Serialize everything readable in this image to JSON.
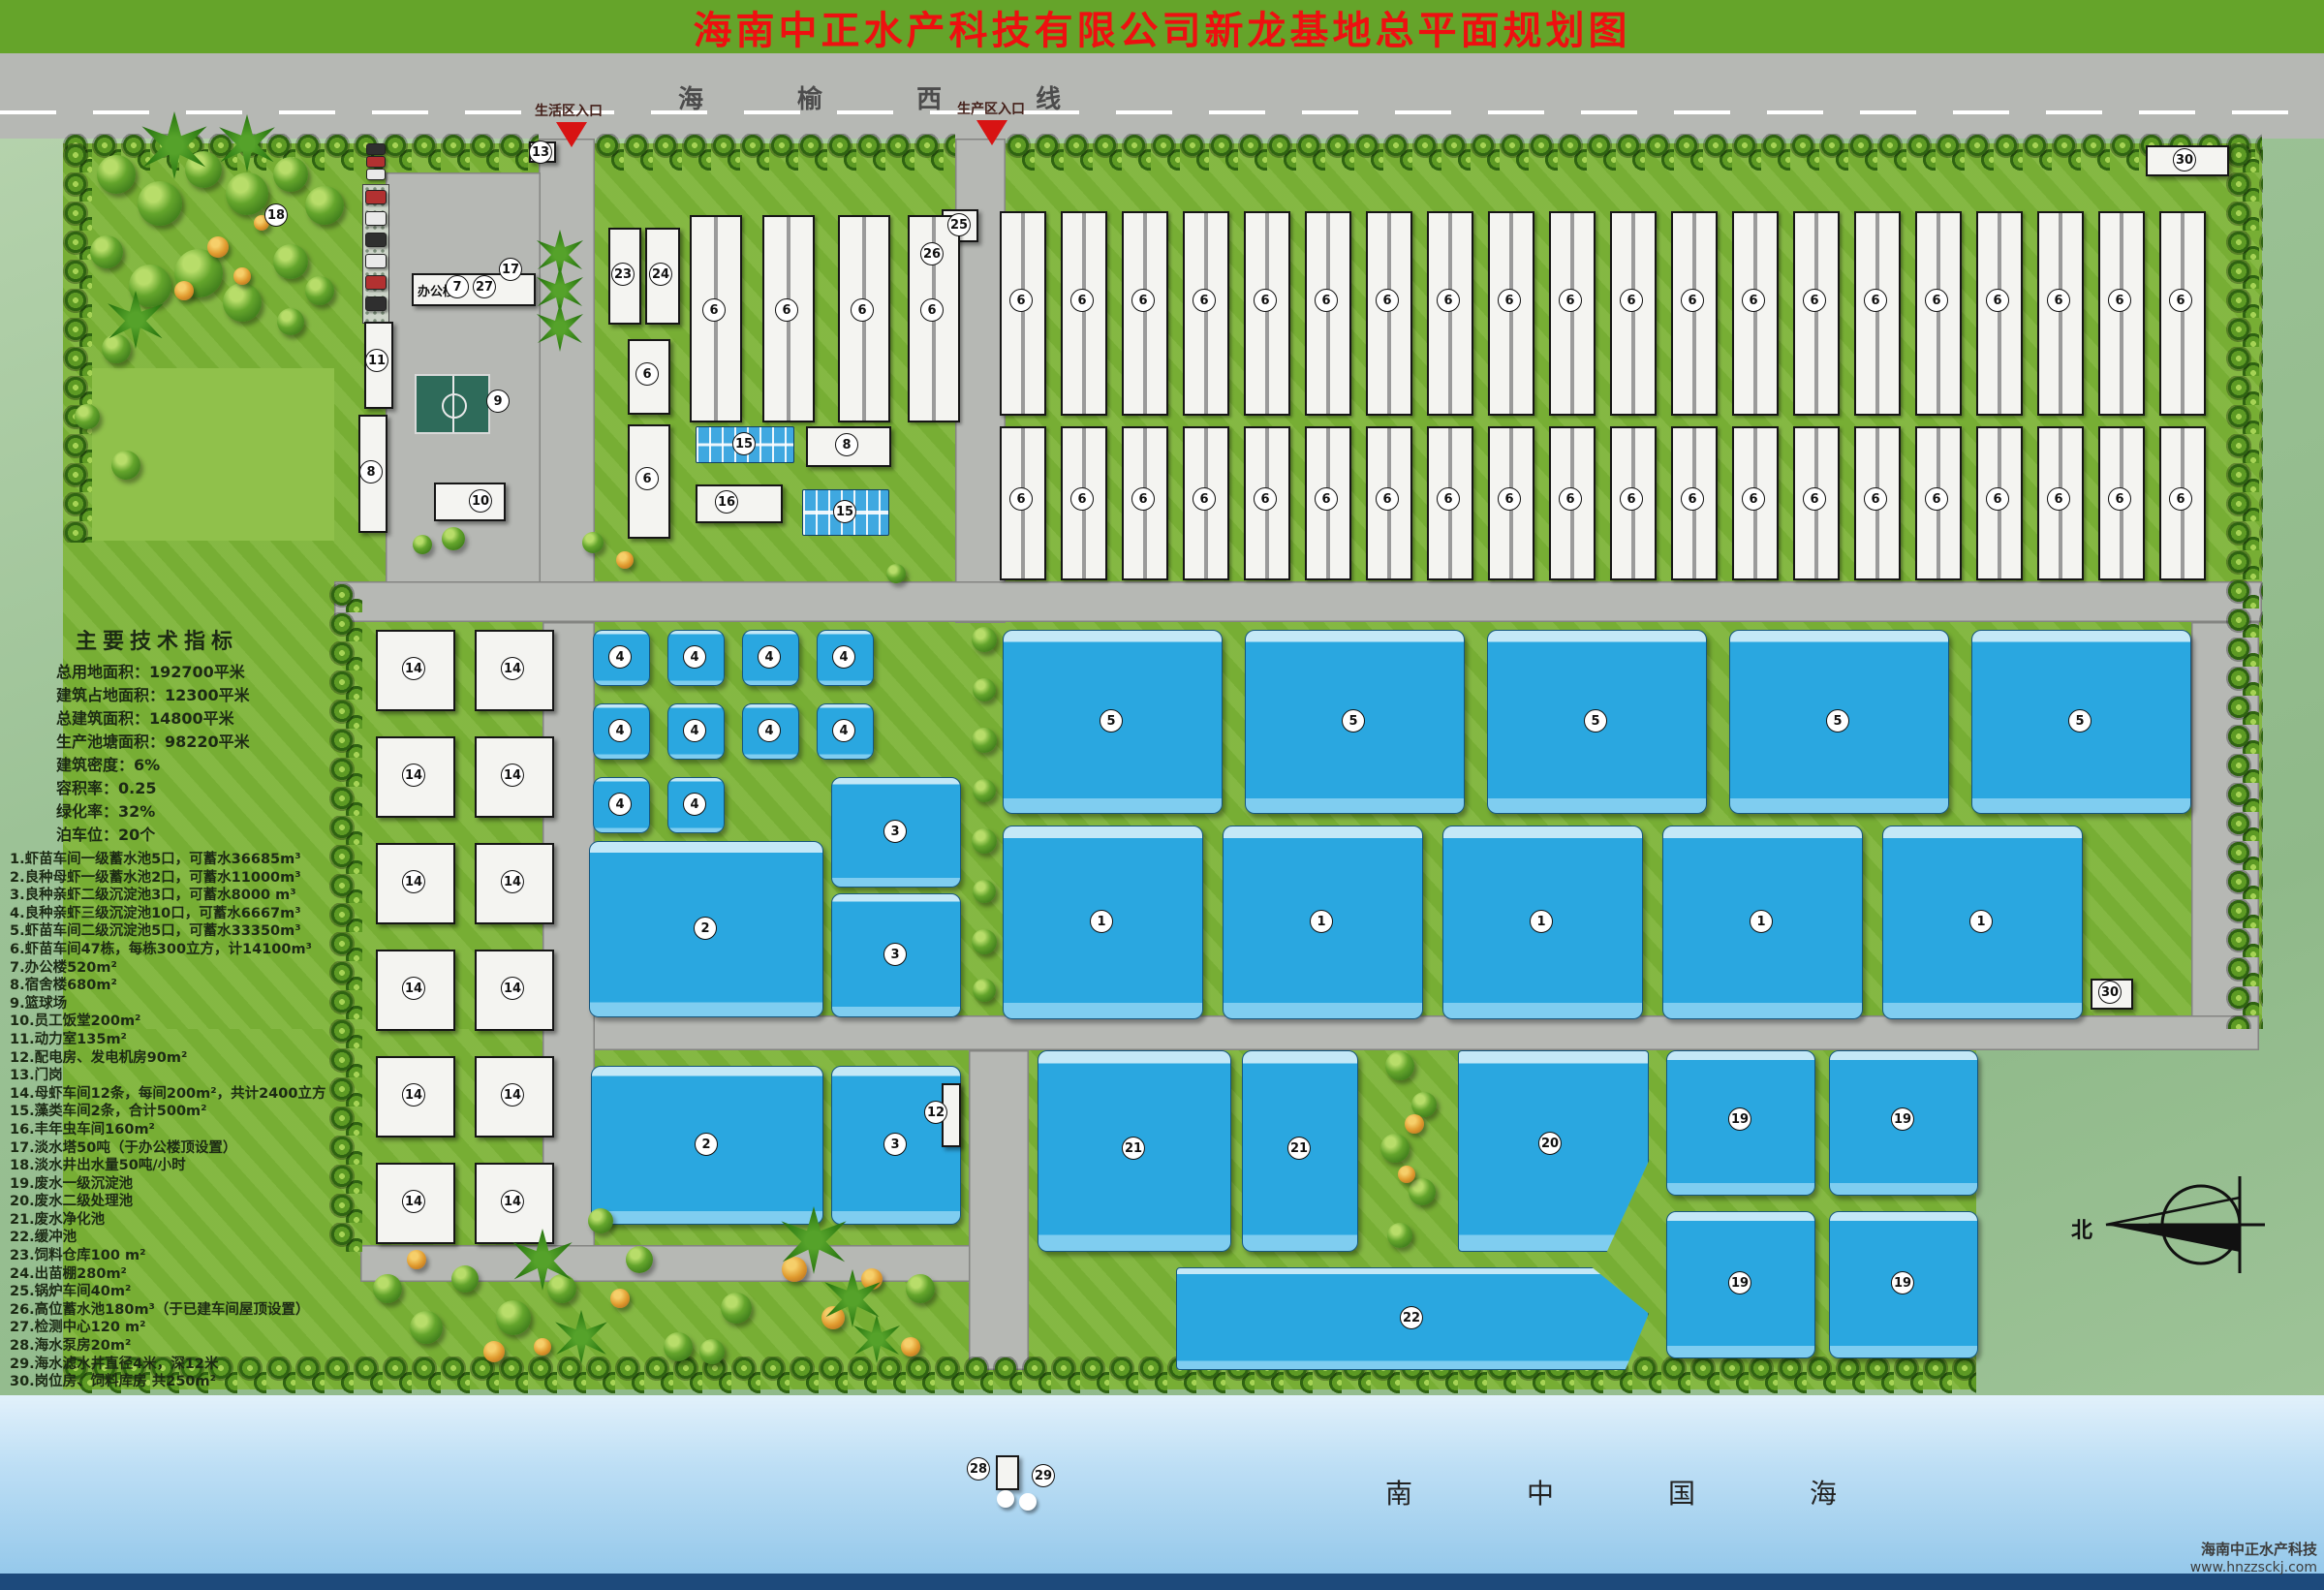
{
  "title": "海南中正水产科技有限公司新龙基地总平面规划图",
  "road": {
    "name": "海  榆  西  线",
    "entry_life": "生活区入口",
    "entry_prod": "生产区入口"
  },
  "sea": {
    "label": "南中国海"
  },
  "compass": {
    "label": "北"
  },
  "office_label": "办公楼",
  "watermark": {
    "company": "海南中正水产科技",
    "url": "www.hnzzsckj.com"
  },
  "indicators": {
    "heading": "主要技术指标",
    "lines": [
      "总用地面积：192700平米",
      "建筑占地面积：12300平米",
      "总建筑面积：14800平米",
      "生产池塘面积：98220平米",
      "建筑密度：6%",
      "容积率：0.25",
      "绿化率：32%",
      "泊车位：20个"
    ]
  },
  "legend": [
    "1.虾苗车间一级蓄水池5口，可蓄水36685m³",
    "2.良种母虾一级蓄水池2口，可蓄水11000m³",
    "3.良种亲虾二级沉淀池3口，可蓄水8000 m³",
    "4.良种亲虾三级沉淀池10口，可蓄水6667m³",
    "5.虾苗车间二级沉淀池5口，可蓄水33350m³",
    "6.虾苗车间47栋，每栋300立方，计14100m³",
    "7.办公楼520m²",
    "8.宿舍楼680m²",
    "9.篮球场",
    "10.员工饭堂200m²",
    "11.动力室135m²",
    "12.配电房、发电机房90m²",
    "13.门岗",
    "14.母虾车间12条，每间200m²，共计2400立方",
    "15.藻类车间2条，合计500m²",
    "16.丰年虫车间160m²",
    "17.淡水塔50吨（于办公楼顶设置）",
    "18.淡水井出水量50吨/小时",
    "19.废水一级沉淀池",
    "20.废水二级处理池",
    "21.废水净化池",
    "22.缓冲池",
    "23.饲料仓库100 m²",
    "24.出苗棚280m²",
    "25.锅炉车间40m²",
    "26.高位蓄水池180m³（于已建车间屋顶设置）",
    "27.检测中心120 m²",
    "28.海水泵房20m²",
    "29.海水滤水井直径4米，深12米",
    "30.岗位房、饲料库房 共250m²"
  ],
  "colors": {
    "title_bg": "#65a42a",
    "title_text": "#ee1010",
    "site_green": "#7db437",
    "road_gray": "#b6b8b4",
    "pond_blue": "#2aa7e0",
    "sea_blue": "#8fc5e9",
    "bar_navy": "#1d4a7c"
  },
  "markers": [
    [
      18,
      285,
      222
    ],
    [
      13,
      558,
      157
    ],
    [
      7,
      472,
      296
    ],
    [
      27,
      500,
      296
    ],
    [
      17,
      527,
      278
    ],
    [
      11,
      389,
      372
    ],
    [
      8,
      383,
      487
    ],
    [
      9,
      514,
      414
    ],
    [
      10,
      496,
      517
    ],
    [
      23,
      643,
      283
    ],
    [
      24,
      682,
      283
    ],
    [
      6,
      737,
      320
    ],
    [
      6,
      812,
      320
    ],
    [
      6,
      890,
      320
    ],
    [
      6,
      962,
      320
    ],
    [
      6,
      668,
      386
    ],
    [
      6,
      668,
      494
    ],
    [
      25,
      990,
      232
    ],
    [
      26,
      962,
      262
    ],
    [
      15,
      768,
      458
    ],
    [
      16,
      750,
      518
    ],
    [
      8,
      874,
      459
    ],
    [
      14,
      427,
      690
    ],
    [
      14,
      529,
      690
    ],
    [
      14,
      427,
      800
    ],
    [
      14,
      529,
      800
    ],
    [
      14,
      427,
      910
    ],
    [
      14,
      529,
      910
    ],
    [
      14,
      427,
      1020
    ],
    [
      14,
      529,
      1020
    ],
    [
      14,
      427,
      1130
    ],
    [
      14,
      529,
      1130
    ],
    [
      14,
      427,
      1240
    ],
    [
      14,
      529,
      1240
    ],
    [
      4,
      640,
      678
    ],
    [
      4,
      717,
      678
    ],
    [
      4,
      794,
      678
    ],
    [
      4,
      871,
      678
    ],
    [
      4,
      640,
      754
    ],
    [
      4,
      717,
      754
    ],
    [
      4,
      794,
      754
    ],
    [
      4,
      871,
      754
    ],
    [
      4,
      640,
      830
    ],
    [
      4,
      717,
      830
    ],
    [
      3,
      924,
      858
    ],
    [
      2,
      728,
      958
    ],
    [
      3,
      924,
      985
    ],
    [
      15,
      872,
      528
    ],
    [
      6,
      1054,
      310
    ],
    [
      6,
      1117,
      310
    ],
    [
      6,
      1180,
      310
    ],
    [
      6,
      1243,
      310
    ],
    [
      6,
      1306,
      310
    ],
    [
      6,
      1369,
      310
    ],
    [
      6,
      1432,
      310
    ],
    [
      6,
      1495,
      310
    ],
    [
      6,
      1558,
      310
    ],
    [
      6,
      1621,
      310
    ],
    [
      6,
      1684,
      310
    ],
    [
      6,
      1747,
      310
    ],
    [
      6,
      1810,
      310
    ],
    [
      6,
      1873,
      310
    ],
    [
      6,
      1936,
      310
    ],
    [
      6,
      1999,
      310
    ],
    [
      6,
      2062,
      310
    ],
    [
      6,
      2125,
      310
    ],
    [
      6,
      2188,
      310
    ],
    [
      6,
      2251,
      310
    ],
    [
      6,
      1054,
      515
    ],
    [
      6,
      1117,
      515
    ],
    [
      6,
      1180,
      515
    ],
    [
      6,
      1243,
      515
    ],
    [
      6,
      1306,
      515
    ],
    [
      6,
      1369,
      515
    ],
    [
      6,
      1432,
      515
    ],
    [
      6,
      1495,
      515
    ],
    [
      6,
      1558,
      515
    ],
    [
      6,
      1621,
      515
    ],
    [
      6,
      1684,
      515
    ],
    [
      6,
      1747,
      515
    ],
    [
      6,
      1810,
      515
    ],
    [
      6,
      1873,
      515
    ],
    [
      6,
      1936,
      515
    ],
    [
      6,
      1999,
      515
    ],
    [
      6,
      2062,
      515
    ],
    [
      6,
      2125,
      515
    ],
    [
      6,
      2188,
      515
    ],
    [
      6,
      2251,
      515
    ],
    [
      5,
      1147,
      744
    ],
    [
      5,
      1397,
      744
    ],
    [
      5,
      1647,
      744
    ],
    [
      5,
      1897,
      744
    ],
    [
      5,
      2147,
      744
    ],
    [
      1,
      1137,
      951
    ],
    [
      1,
      1364,
      951
    ],
    [
      1,
      1591,
      951
    ],
    [
      1,
      1818,
      951
    ],
    [
      1,
      2045,
      951
    ],
    [
      2,
      729,
      1181
    ],
    [
      3,
      924,
      1181
    ],
    [
      12,
      966,
      1148
    ],
    [
      21,
      1170,
      1185
    ],
    [
      21,
      1341,
      1185
    ],
    [
      20,
      1600,
      1180
    ],
    [
      19,
      1796,
      1155
    ],
    [
      19,
      1964,
      1155
    ],
    [
      19,
      1796,
      1324
    ],
    [
      19,
      1964,
      1324
    ],
    [
      22,
      1457,
      1360
    ],
    [
      30,
      2255,
      165
    ],
    [
      30,
      2178,
      1024
    ],
    [
      28,
      1010,
      1516
    ],
    [
      29,
      1077,
      1523
    ]
  ]
}
